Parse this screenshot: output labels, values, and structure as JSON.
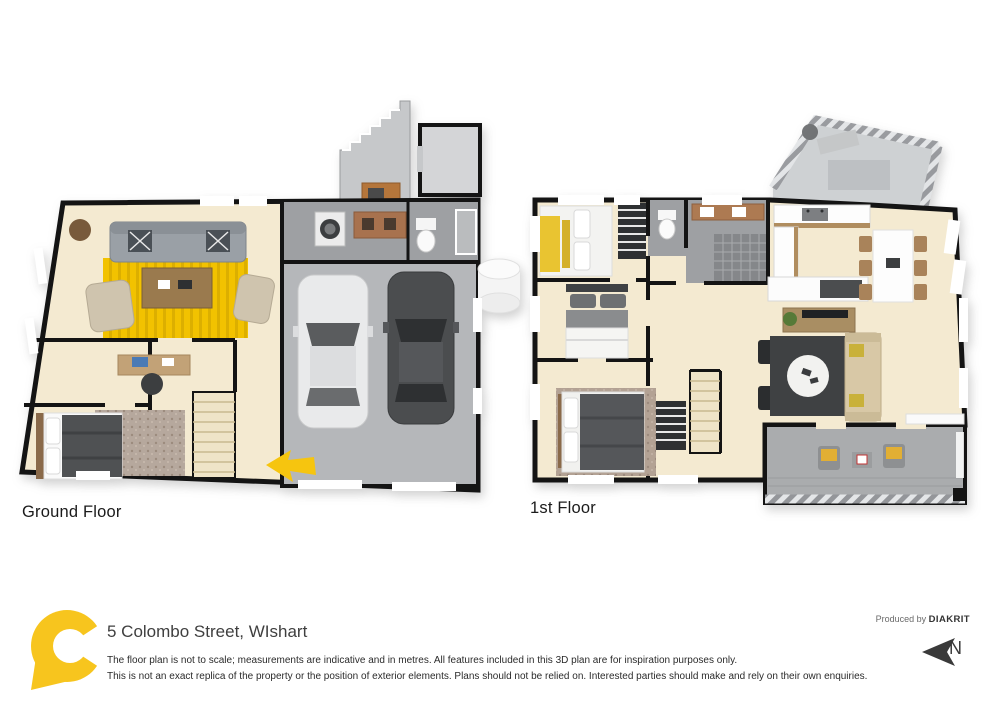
{
  "plans": {
    "ground": {
      "label": "Ground Floor"
    },
    "first": {
      "label": "1st Floor"
    }
  },
  "footer": {
    "address": "5 Colombo Street, WIshart",
    "disclaimer_line1": "The floor plan is not to scale; measurements are indicative and in metres. All features included in this 3D plan are for inspiration purposes only.",
    "disclaimer_line2": "This is not an exact replica of the property or the position of exterior elements. Plans should not be relied on. Interested parties should make and rely on their own enquiries.",
    "produced_by": "Produced by",
    "brand": "DIAKRIT",
    "north_label": "N"
  },
  "icons": {
    "logo": "brand-c-pin-logo",
    "north_arrow": "north-arrow",
    "entry_arrow": "entry-direction-arrow"
  },
  "colors": {
    "accent_yellow": "#F5C518",
    "rug_yellow": "#F2C200",
    "floor_cream": "#F4EAD1",
    "wall_black": "#141414",
    "tile_grey": "#9EA0A3",
    "garage_grey": "#B5B7BA",
    "label_text": "#1B1B1B"
  }
}
